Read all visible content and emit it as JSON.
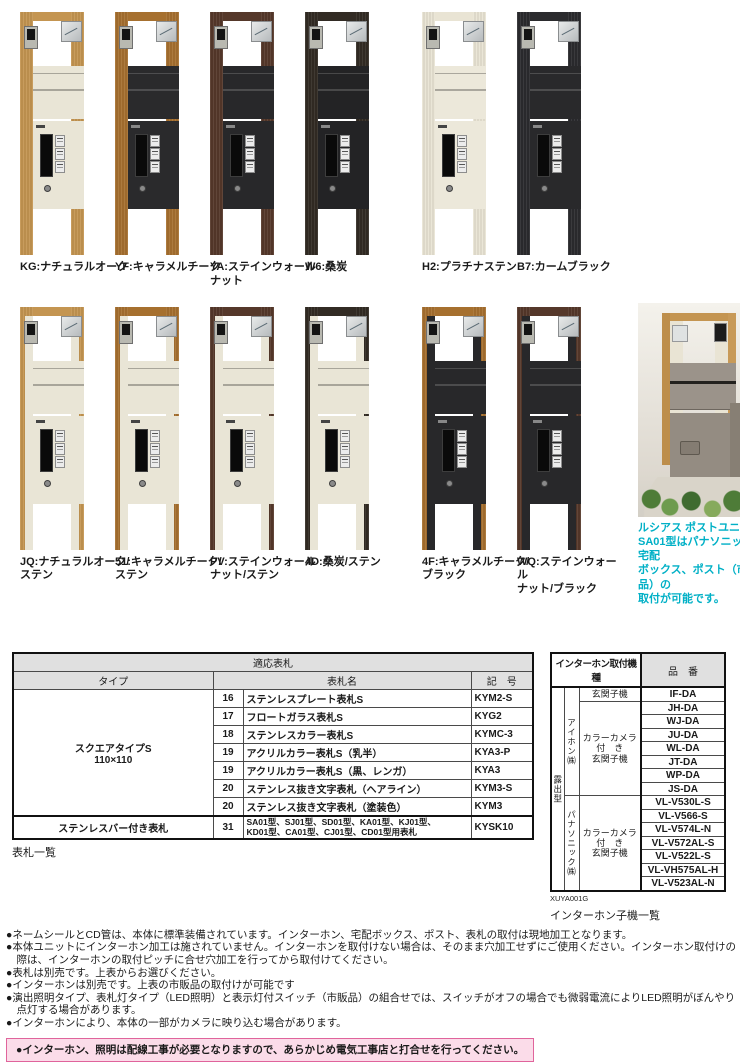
{
  "products": [
    {
      "label": "KG:ナチュラルオーク",
      "frame": "#c49551",
      "panel": "#e9e5d6",
      "two_tone": false,
      "dark": false
    },
    {
      "label": "YF:キャラメルチーク",
      "frame": "#a6702f",
      "panel": "#2a2a2c",
      "two_tone": false,
      "dark": true
    },
    {
      "label": "YA:ステインウォール\nナット",
      "frame": "#55382a",
      "panel": "#28282a",
      "two_tone": false,
      "dark": true
    },
    {
      "label": "W6:桑炭",
      "frame": "#322b24",
      "panel": "#232325",
      "two_tone": false,
      "dark": true
    },
    {
      "label": "H2:プラチナステン",
      "frame": "#e9e4d4",
      "panel": "#ece8da",
      "two_tone": false,
      "dark": false
    },
    {
      "label": "B7:カームブラック",
      "frame": "#2b2b2e",
      "panel": "#29292b",
      "two_tone": false,
      "dark": true
    },
    {
      "label": "JQ:ナチュラルオーク/\nステン",
      "frame": "#c49551",
      "panel": "#e9e5d6",
      "two_tone": true,
      "dark": false
    },
    {
      "label": "51:キャラメルチーク/\nステン",
      "frame": "#a6702f",
      "panel": "#e9e5d6",
      "two_tone": true,
      "dark": false
    },
    {
      "label": "PV:ステインウォール\nナット/ステン",
      "frame": "#55382a",
      "panel": "#e9e5d6",
      "two_tone": true,
      "dark": false
    },
    {
      "label": "4D:桑炭/ステン",
      "frame": "#322b24",
      "panel": "#e9e5d6",
      "two_tone": true,
      "dark": false
    },
    {
      "label": "4F:キャラメルチーク/\nブラック",
      "frame": "#a6702f",
      "panel": "#28282a",
      "two_tone": true,
      "dark": true
    },
    {
      "label": "WQ:ステインウォール\nナット/ブラック",
      "frame": "#55382a",
      "panel": "#28282a",
      "two_tone": true,
      "dark": true
    }
  ],
  "photo": {
    "caption": "ルシアス ポストユニット\nSA01型はパナソニック製宅配\nボックス、ポスト（市販品）の\n取付が可能です。",
    "caption_color": "#00b0c6"
  },
  "nameplate_table": {
    "title": "適応表札",
    "col_type": "タイプ",
    "col_name": "表札名",
    "col_code": "記　号",
    "group1_type": "スクエアタイプS\n110×110",
    "group2_type": "ステンレスバー付き表札",
    "rows": [
      {
        "no": "16",
        "name": "ステンレスプレート表札S",
        "code": "KYM2-S"
      },
      {
        "no": "17",
        "name": "フロートガラス表札S",
        "code": "KYG2"
      },
      {
        "no": "18",
        "name": "ステンレスカラー表札S",
        "code": "KYMC-3"
      },
      {
        "no": "19",
        "name": "アクリルカラー表札S（乳半）",
        "code": "KYA3-P"
      },
      {
        "no": "19",
        "name": "アクリルカラー表札S（黒、レンガ）",
        "code": "KYA3"
      },
      {
        "no": "20",
        "name": "ステンレス抜き文字表札（ヘアライン）",
        "code": "KYM3-S"
      },
      {
        "no": "20",
        "name": "ステンレス抜き文字表札（塗装色）",
        "code": "KYM3"
      },
      {
        "no": "31",
        "name": "SA01型、SJ01型、SD01型、KA01型、KJ01型、\nKD01型、CA01型、CJ01型、CD01型用表札",
        "code": "KYSK10"
      }
    ],
    "caption": "表札一覧"
  },
  "intercom_table": {
    "title": "インターホン取付機種",
    "col_part": "品　番",
    "mount": "露出型",
    "maker1": "アイホン㈱",
    "maker2": "パナソニック㈱",
    "type1": "玄関子機",
    "type2": "カラーカメラ\n付　き\n玄関子機",
    "type3": "カラーカメラ\n付　き\n玄関子機",
    "aiphone_models": [
      "IF-DA",
      "JH-DA",
      "WJ-DA",
      "JU-DA",
      "WL-DA",
      "JT-DA",
      "WP-DA",
      "JS-DA"
    ],
    "panasonic_models": [
      "VL-V530L-S",
      "VL-V566-S",
      "VL-V574L-N",
      "VL-V572AL-S",
      "VL-V522L-S",
      "VL-VH575AL-H",
      "VL-V523AL-N"
    ],
    "doc_code": "XUYA001G",
    "caption": "インターホン子機一覧"
  },
  "notes": [
    "●ネームシールとCD管は、本体に標準装備されています。インターホン、宅配ボックス、ポスト、表札の取付は現地加工となります。",
    "●本体ユニットにインターホン加工は施されていません。インターホンを取付けない場合は、そのまま穴加工せずにご使用ください。インターホン取付けの際は、インターホンの取付ピッチに合せ穴加工を行ってから取付けてください。",
    "●表札は別売です。上表からお選びください。",
    "●インターホンは別売です。上表の市販品の取付けが可能です",
    "●演出照明タイプ、表札灯タイプ（LED照明）と表示灯付スイッチ（市販品）の組合せでは、スイッチがオフの場合でも微弱電流によりLED照明がぼんやり点灯する場合があります。",
    "●インターホンにより、本体の一部がカメラに映り込む場合があります。"
  ],
  "warning": "●インターホン、照明は配線工事が必要となりますので、あらかじめ電気工事店と打合せを行ってください。"
}
